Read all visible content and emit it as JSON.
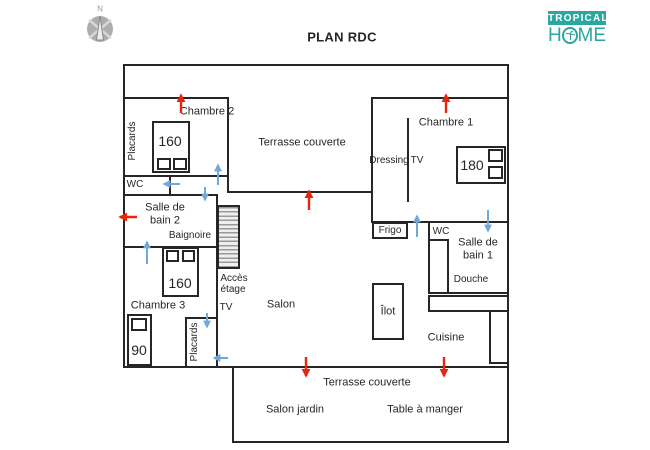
{
  "header": {
    "title": "PLAN RDC",
    "compass_north": "N"
  },
  "logo": {
    "word_top": "TROPICAL",
    "home_h": "H",
    "home_me": "ME"
  },
  "plan": {
    "rooms": {
      "chambre_2": "Chambre 2",
      "chambre_1": "Chambre 1",
      "chambre_3": "Chambre 3",
      "terrasse_couverte_nord": "Terrasse couverte",
      "terrasse_couverte_sud": "Terrasse couverte",
      "salon": "Salon",
      "cuisine": "Cuisine",
      "dressing": "Dressing",
      "wc_gauche": "WC",
      "wc_droite": "WC",
      "salle_de_bain_2_l1": "Salle de",
      "salle_de_bain_2_l2": "bain 2",
      "salle_de_bain_1_l1": "Salle de",
      "salle_de_bain_1_l2": "bain 1",
      "salon_jardin": "Salon jardin",
      "table_a_manger": "Table à manger"
    },
    "equipements": {
      "placards_chambre_2": "Placards",
      "placards_chambre_3": "Placards",
      "baignoire": "Baignoire",
      "douche": "Douche",
      "frigo": "Frigo",
      "ilot": "Îlot",
      "tv_salon": "TV",
      "tv_chambre_1": "TV",
      "acces_etage_l1": "Accès",
      "acces_etage_l2": "étage"
    },
    "lits": {
      "chambre_2": "160",
      "chambre_1": "180",
      "chambre_3_double": "160",
      "chambre_3_simple": "90"
    },
    "colors": {
      "mur": "#262626",
      "fleche_rouge": "#e8250f",
      "fleche_bleue": "#6fa8dc",
      "logo_teal": "#2aa7a1",
      "escalier_gris": "#999999",
      "boussole_gris": "#adadad"
    }
  }
}
